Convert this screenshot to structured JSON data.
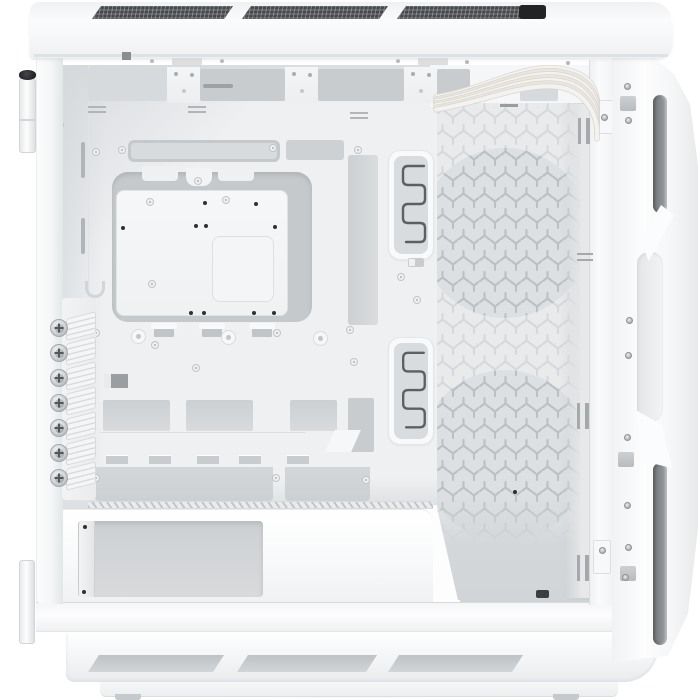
{
  "scene": {
    "subject": "White ATX mid-tower PC case, left side panel removed, interior view",
    "background_color": "#ffffff"
  },
  "palette": {
    "case_white": "#fdfdfe",
    "tray_gray": "#eef0f2",
    "cutout_gray": "#c9ccce",
    "cutout_dark": "#9b9ea1",
    "groove_dark": "#74777a",
    "screw_black": "#2e3032",
    "hinge_screw_black": "#141517",
    "cable_white": "#f4f2ee",
    "pattern_light": "#d4d7d9",
    "pattern_dense": "#bcc0c3",
    "vent_dark": "#54575a",
    "connector_black": "#212325"
  },
  "top_panel": {
    "vent_slots": [
      {
        "x": 62,
        "w": 141
      },
      {
        "x": 212,
        "w": 146
      },
      {
        "x": 367,
        "w": 149
      }
    ],
    "connector": {
      "x": 489,
      "w": 27
    }
  },
  "top_strip": {
    "screws": [
      [
        152,
        61
      ],
      [
        222,
        61
      ],
      [
        398,
        61
      ],
      [
        467,
        62
      ],
      [
        568,
        63
      ],
      [
        625,
        66
      ]
    ],
    "plates": [
      172,
      418
    ]
  },
  "rear": {
    "thumbscrew_x": 59,
    "thumbscrew_ys": [
      328,
      353,
      378,
      403,
      428,
      453,
      478
    ],
    "hinge_pins": 2
  },
  "tray": {
    "top_openings": [
      {
        "x": 88,
        "w": 79,
        "light": true
      },
      {
        "x": 200,
        "w": 85,
        "light": false
      },
      {
        "x": 318,
        "w": 86,
        "light": false
      },
      {
        "x": 437,
        "w": 33,
        "light": false
      },
      {
        "x": 520,
        "w": 38,
        "light": true
      }
    ],
    "top_tabs": [
      167,
      285,
      404
    ],
    "dash_vents": [
      [
        88,
        106
      ],
      [
        188,
        106
      ],
      [
        350,
        112
      ]
    ],
    "slot_tabs": [
      154,
      202,
      252
    ],
    "rings_large": [
      [
        138,
        336
      ],
      [
        228,
        337
      ],
      [
        320,
        338
      ]
    ],
    "wall_slots": [
      [
        81,
        142
      ],
      [
        81,
        218
      ]
    ],
    "lower_openings": [
      {
        "x": 103,
        "w": 67
      },
      {
        "x": 186,
        "w": 67
      },
      {
        "x": 290,
        "w": 47
      }
    ],
    "slot_vents": [
      106,
      149,
      197,
      239,
      287
    ],
    "shroud_bands": [
      {
        "x": 95,
        "w": 178
      },
      {
        "x": 285,
        "w": 85
      }
    ]
  },
  "channels": [
    {
      "y": 150,
      "h": 110
    },
    {
      "y": 337,
      "h": 108
    }
  ],
  "perf_panel": {
    "w": 152,
    "h": 497,
    "base": "#e8eaec",
    "circle_fill": "#dde0e2",
    "fan_circles": [
      [
        68,
        130,
        85
      ],
      [
        68,
        352,
        85
      ]
    ],
    "dash": {
      "x": 63,
      "y": 1,
      "w": 18,
      "h": 3
    }
  },
  "cables": {
    "count": 7,
    "color_a": "#f4f2ee",
    "color_b": "#e9e6e0",
    "edge": "#d8d5cf"
  },
  "front_rail": {
    "slot_pairs": [
      {
        "x": 578,
        "y": 118,
        "o": "v"
      },
      {
        "x": 577,
        "y": 253,
        "o": "h"
      },
      {
        "x": 577,
        "y": 403,
        "o": "v"
      },
      {
        "x": 577,
        "y": 555,
        "o": "v"
      }
    ],
    "brackets": [
      [
        596,
        100
      ],
      [
        593,
        540
      ]
    ]
  },
  "front_frame": {
    "grooves": [
      {
        "y": 95,
        "h": 118
      },
      {
        "y": 463,
        "h": 182
      }
    ],
    "clips": [
      [
        620,
        96
      ],
      [
        618,
        452
      ],
      [
        620,
        566
      ]
    ]
  },
  "bottom": {
    "vents": [
      {
        "x": 88,
        "w": 136
      },
      {
        "x": 237,
        "w": 140
      },
      {
        "x": 388,
        "w": 135
      }
    ],
    "feet": [
      115,
      553
    ]
  },
  "screws": {
    "ring": [
      [
        60,
        125
      ],
      [
        96,
        152
      ],
      [
        122,
        150
      ],
      [
        273,
        148
      ],
      [
        358,
        150
      ],
      [
        198,
        181
      ],
      [
        150,
        202
      ],
      [
        226,
        200
      ],
      [
        152,
        284
      ],
      [
        96,
        333
      ],
      [
        277,
        333
      ],
      [
        350,
        330
      ],
      [
        155,
        345
      ],
      [
        196,
        368
      ],
      [
        354,
        362
      ],
      [
        401,
        277
      ],
      [
        417,
        300
      ],
      [
        85,
        385
      ],
      [
        96,
        478
      ],
      [
        276,
        478
      ],
      [
        366,
        480
      ],
      [
        95,
        613
      ],
      [
        470,
        617
      ],
      [
        600,
        612
      ]
    ],
    "dark": [
      [
        205,
        203
      ],
      [
        256,
        204
      ],
      [
        196,
        226
      ],
      [
        206,
        226
      ],
      [
        275,
        227
      ],
      [
        123,
        228
      ],
      [
        191,
        313
      ],
      [
        204,
        313
      ],
      [
        254,
        313
      ],
      [
        274,
        313
      ],
      [
        82,
        317
      ],
      [
        85,
        527
      ],
      [
        84,
        592
      ],
      [
        515,
        492
      ]
    ],
    "frame": [
      [
        627,
        86
      ],
      [
        628,
        120
      ],
      [
        629,
        320
      ],
      [
        628,
        355
      ],
      [
        627,
        437
      ],
      [
        627,
        505
      ],
      [
        628,
        547
      ],
      [
        625,
        577
      ],
      [
        604,
        117
      ],
      [
        602,
        550
      ]
    ]
  }
}
